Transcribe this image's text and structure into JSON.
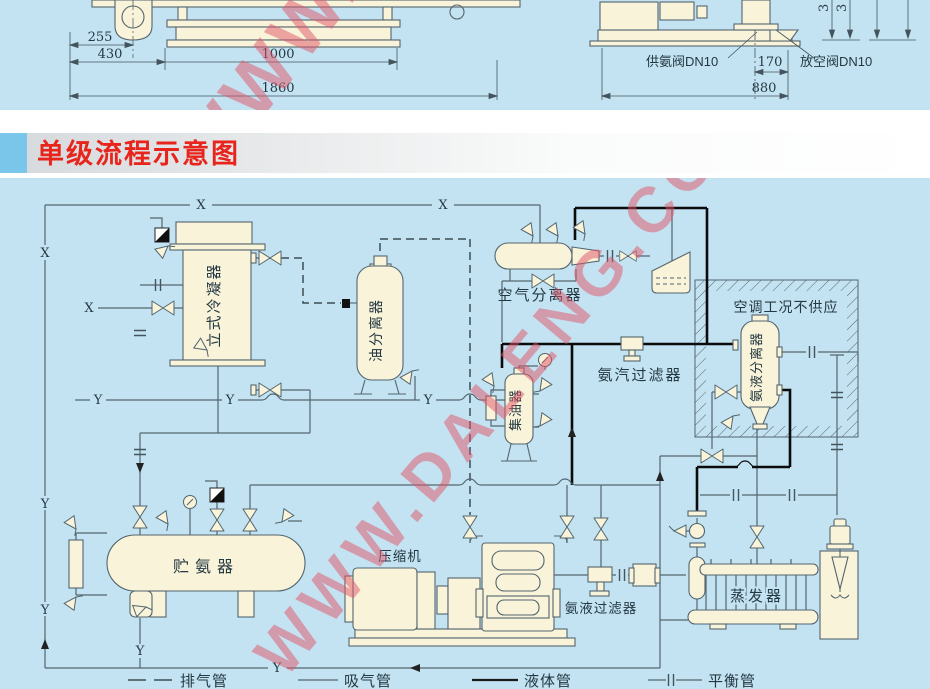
{
  "colors": {
    "panel_blue": "#c3e3f2",
    "banner_red": "#e8251d",
    "watermark_pink": "#e25568",
    "vessel_cream": "#f8f3d9",
    "line_gray": "#54656e"
  },
  "watermark": {
    "text": "WWW.DALENG.CC"
  },
  "top_section": {
    "left_drawing": {
      "dim_255": "255",
      "dim_430": "430",
      "dim_1000": "1000",
      "dim_1860": "1860"
    },
    "right_drawing": {
      "supply_valve_label": "供氨阀DN10",
      "dim_170": "170",
      "vent_valve_label": "放空阀DN10",
      "dim_880": "880",
      "vertical_dim_a": "3",
      "vertical_dim_b": "3"
    }
  },
  "banner": {
    "title": "单级流程示意图"
  },
  "diagram": {
    "equipment": {
      "vertical_condenser": "立式冷凝器",
      "oil_separator": "油分离器",
      "air_separator": "空气分离器",
      "ac_condition_note": "空调工况不供应",
      "ammonia_vapor_filter": "氨汽过滤器",
      "ammonia_liquid_separator": "氨液分离器",
      "oil_collector": "集油器",
      "ammonia_receiver": "贮氨器",
      "compressor": "压缩机",
      "ammonia_liquid_filter": "氨液过滤器",
      "evaporator": "蒸发器"
    },
    "pipe_markers": {
      "x": "X",
      "y": "Y"
    },
    "legend": {
      "discharge_pipe": "排气管",
      "suction_pipe": "吸气管",
      "liquid_pipe": "液体管",
      "balance_pipe": "平衡管"
    }
  }
}
